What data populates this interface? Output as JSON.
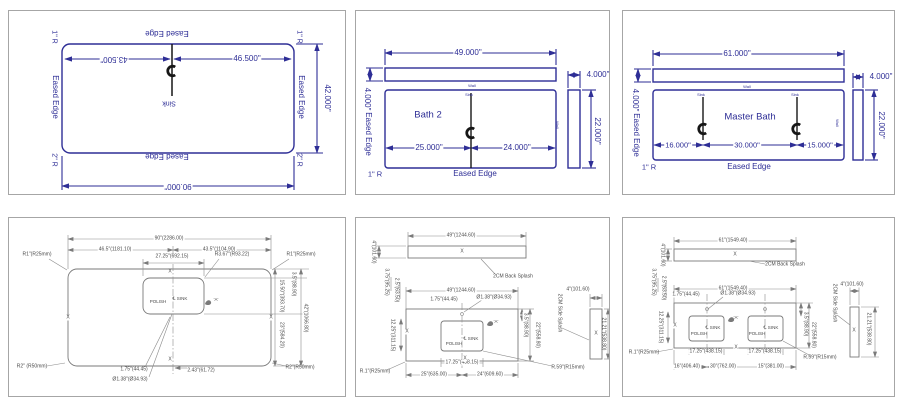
{
  "colors": {
    "blueprint_blue": "#2e2e96",
    "cad_line_gray": "#7a7a7a",
    "cad_text_gray": "#4a4a4a",
    "panel_border": "#a6a6a6",
    "centerline_black": "#161616"
  },
  "p1": {
    "edge_top": "Eased Edge",
    "edge_bottom": "Eased Edge",
    "edge_left": "Eased Edge",
    "edge_right": "Eased Edge",
    "corner_tl": "1\" R",
    "corner_tr": "1\" R",
    "corner_bl": "2\" R",
    "corner_br": "2\" R",
    "dim_left": "43.500\"",
    "dim_right": "46.500\"",
    "dim_depth": "42.000\"",
    "dim_width": "90.000\"",
    "sink": "Sink"
  },
  "p2": {
    "room": "Bath 2",
    "dim_top": "49.000\"",
    "dim_splash_height": "4.000\"",
    "dim_side_splash_width": "4.000\"",
    "dim_sink_left": "25.000\"",
    "dim_sink_right": "24.000\"",
    "dim_depth": "22.000\"",
    "edge_left": "Eased Edge",
    "edge_bottom": "Eased Edge",
    "corner": "1\" R",
    "wall_top": "Wall",
    "wall_right": "Wall",
    "sink": "Sink"
  },
  "p3": {
    "room": "Master Bath",
    "dim_top": "61.000\"",
    "dim_splash_height": "4.000\"",
    "dim_side_splash_width": "4.000\"",
    "dim_b1": "16.000\"",
    "dim_b2": "30.000\"",
    "dim_b3": "15.000\"",
    "dim_depth": "22.000\"",
    "edge_left": "Eased Edge",
    "edge_bottom": "Eased Edge",
    "corner": "1\" R",
    "wall_top": "Wall",
    "wall_right": "Wall",
    "sink1": "Sink",
    "sink2": "Sink"
  },
  "p4": {
    "dim_total": "90\"(2286.00)",
    "dim_seg_left": "46.5\"(1181.10)",
    "dim_seg_right": "43.5\"(1104.90)",
    "dim_sink_width": "27.25\"(692.15)",
    "sink_corner_radius": "R3.67\"(R93.22)",
    "corner_tl": "R1\"(R25mm)",
    "corner_tr": "R1\"(R25mm)",
    "corner_bl": "R2\" (R50mm)",
    "corner_br": "R2\"(R50mm)",
    "polish": "POLISH",
    "sink": "℄ SINK",
    "detail": "'A'",
    "dim_r_top": "3.5\"(88.90)",
    "dim_r_sink": "15.50\"(393.70)",
    "dim_r_bottom": "23\"(584.20)",
    "dim_r_total": "42\"(1066.80)",
    "dim_faucet_offset": "1.75\"(44.45)",
    "dim_hole": "Ø1.38\"(Ø34.93)",
    "dim_hole_offset": "2.43\"(61.72)",
    "edge_mark": "X"
  },
  "p5": {
    "dim_splash_width": "49\"(1244.60)",
    "dim_splash_height": "4\"(101.60)",
    "backsplash": "2CM Back Splash",
    "dim_top": "49\"(1244.60)",
    "dim_l1": "3.75\"(95.25)",
    "dim_l2": "2.5\"(63.50)",
    "dim_l3": "12.25\"(311.15)",
    "dim_faucet_offset": "1.75\"(44.45)",
    "dim_hole": "Ø1.38\"(Ø34.93)",
    "polish": "POLISH",
    "sink": "℄ SINK",
    "detail": "'A'",
    "dim_r1": "3.5\"(88.90)",
    "dim_r2": "22\"(558.80)",
    "dim_sink_width": "17.25\"(438.15)",
    "dim_b1": "25\"(635.00)",
    "dim_b2": "24\"(609.60)",
    "corner_bl": "R.1\"(R25mm)",
    "corner_br": "R.59\"(R15mm)",
    "side_splash": "2CM Side Splash",
    "dim_ss_width": "4\"(101.60)",
    "dim_ss_height": "21.21\"(538.80)",
    "edge_mark": "X"
  },
  "p6": {
    "dim_splash_width": "61\"(1549.40)",
    "dim_splash_height": "4\"(101.60)",
    "backsplash": "2CM Back Splash",
    "dim_top": "61\"(1549.40)",
    "dim_l1": "3.75\"(95.25)",
    "dim_l2": "2.5\"(63.50)",
    "dim_l3": "12.25\"(311.15)",
    "dim_faucet_offset": "1.75\"(44.45)",
    "dim_hole": "Ø1.38\"(Ø34.93)",
    "polish1": "POLISH",
    "sink1": "℄ SINK",
    "polish2": "POLISH",
    "sink2": "℄ SINK",
    "detail": "'A'",
    "dim_r1": "3.5\"(88.90)",
    "dim_r2": "22\"(558.80)",
    "dim_sink1_width": "17.25\"(438.15)",
    "dim_sink2_width": "17.25\"(438.15)",
    "dim_b1": "16\"(406.40)",
    "dim_b2": "30\"(762.00)",
    "dim_b3": "15\"(381.00)",
    "corner_bl": "R.1\"(R25mm)",
    "corner_br": "R.59\"(R15mm)",
    "side_splash": "2CM Side Splash",
    "dim_ss_width": "4\"(101.60)",
    "dim_ss_height": "21.21\"(538.80)",
    "edge_mark": "X"
  }
}
